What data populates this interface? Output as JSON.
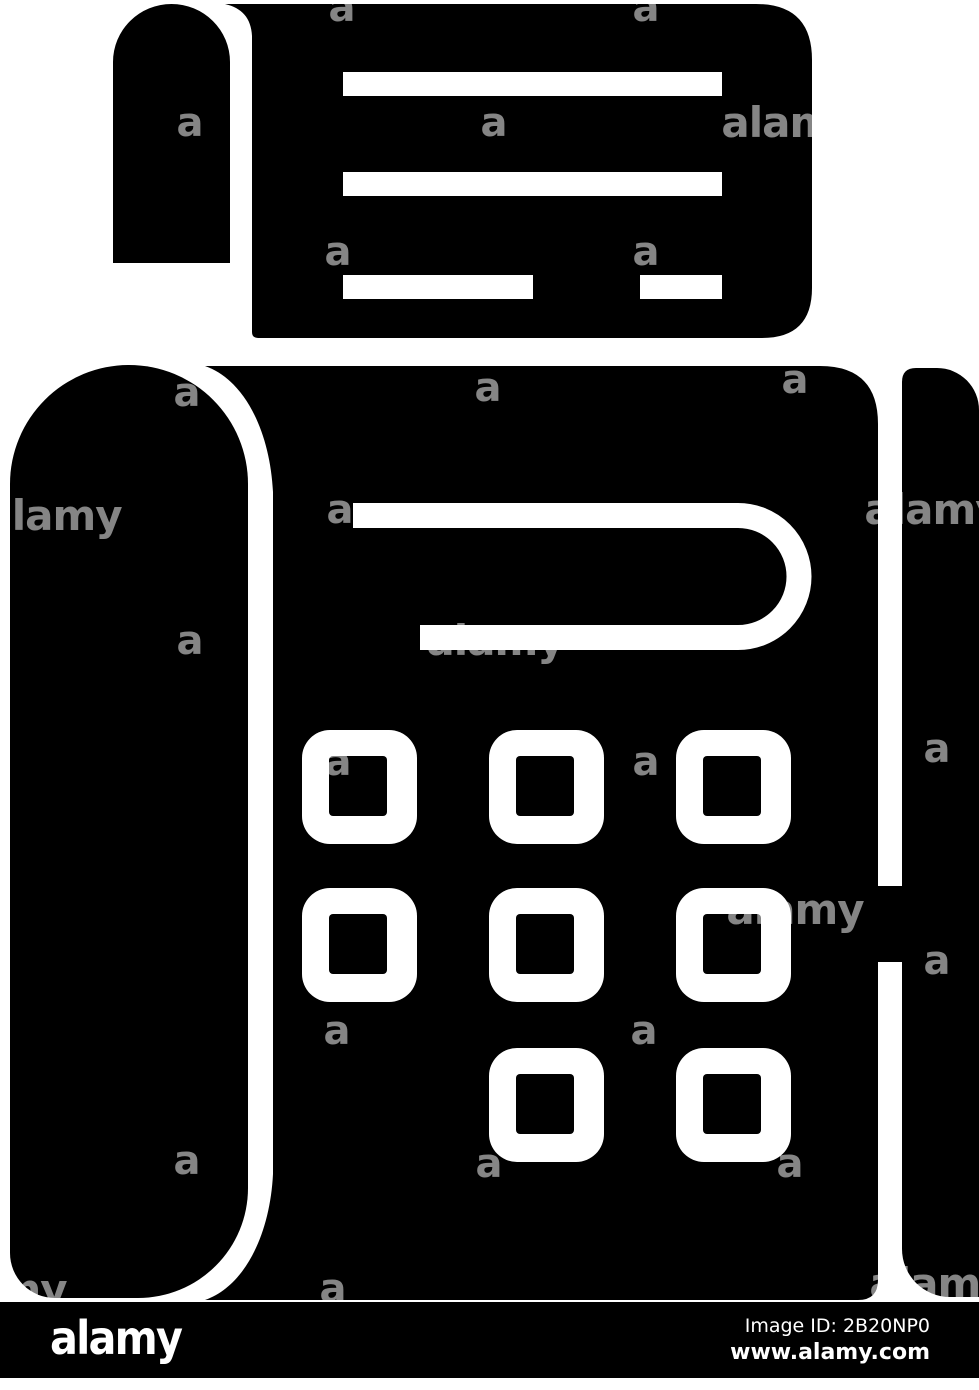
{
  "page": {
    "background": "#ffffff"
  },
  "icon": {
    "name": "fax-machine-glyph-icon",
    "color": "#000000",
    "detail_color": "#ffffff",
    "parts": [
      "printed-document",
      "paper-curl-tab",
      "document-text-lines",
      "phone-handset",
      "machine-body",
      "paper-slot",
      "keypad",
      "paper-roll-strip",
      "body-strip-connector"
    ],
    "keypad": {
      "rows": 3,
      "columns": 3,
      "buttons_visible": 8
    }
  },
  "watermark": {
    "color": "rgba(255,255,255,0.52)",
    "letter": "a",
    "word": "alamy",
    "letters": [
      [
        342,
        8
      ],
      [
        646,
        8
      ],
      [
        190,
        123
      ],
      [
        494,
        123
      ],
      [
        338,
        252
      ],
      [
        646,
        252
      ],
      [
        187,
        393
      ],
      [
        488,
        388
      ],
      [
        795,
        380
      ],
      [
        340,
        510
      ],
      [
        190,
        641
      ],
      [
        338,
        762
      ],
      [
        646,
        762
      ],
      [
        937,
        749
      ],
      [
        337,
        1031
      ],
      [
        644,
        1031
      ],
      [
        937,
        961
      ],
      [
        187,
        1161
      ],
      [
        489,
        1164
      ],
      [
        790,
        1164
      ],
      [
        333,
        1289
      ]
    ],
    "words": [
      [
        790,
        123
      ],
      [
        53,
        516
      ],
      [
        933,
        510
      ],
      [
        495,
        641
      ],
      [
        795,
        910
      ],
      [
        938,
        1284
      ],
      [
        -2,
        1290
      ]
    ]
  },
  "footer": {
    "background": "#000000",
    "text_color": "#ffffff",
    "logo_text": "alamy",
    "image_id_label": "Image ID: 2B20NP0",
    "url_text": "www.alamy.com"
  }
}
